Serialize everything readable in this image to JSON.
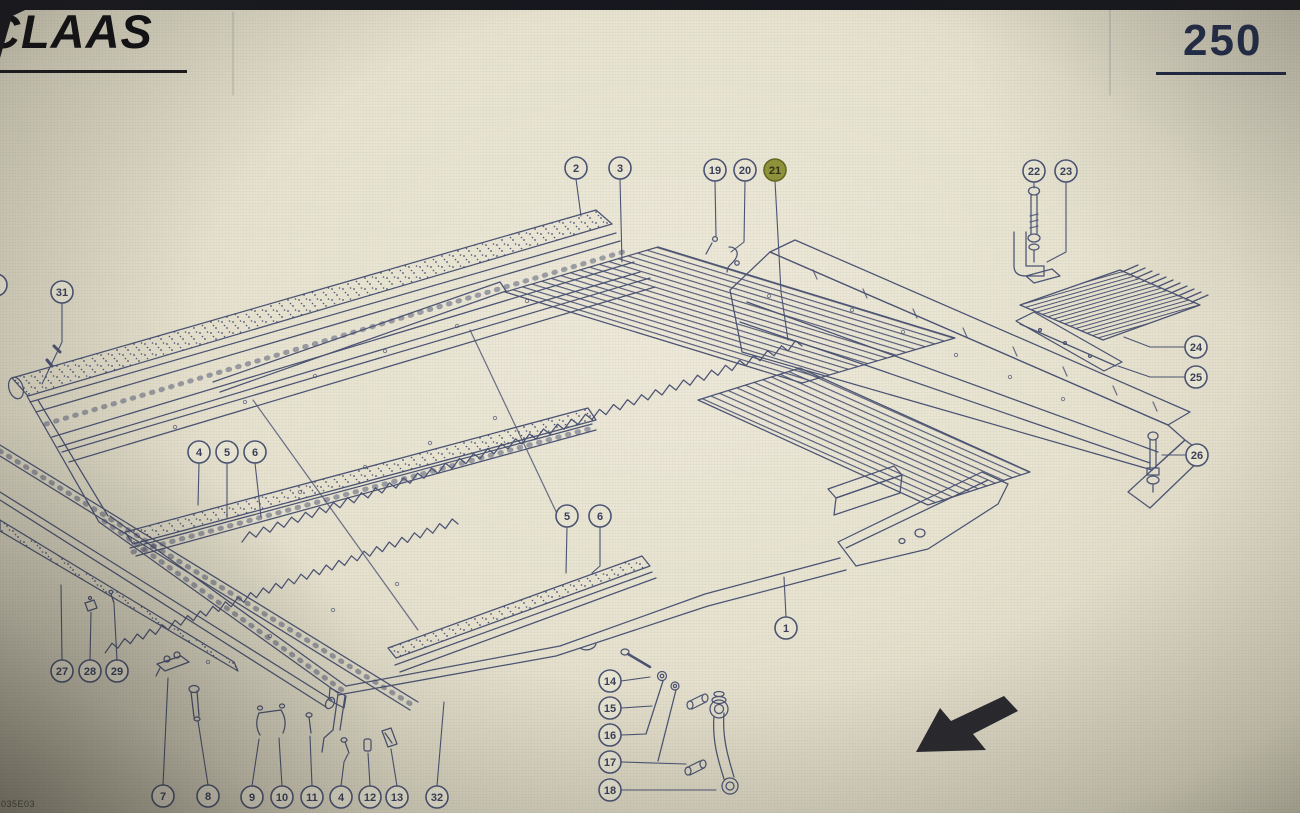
{
  "header": {
    "brand": "CLAAS",
    "page_number": "250"
  },
  "footer": {
    "doc_code": "035E03"
  },
  "colors": {
    "paper": "#e7e3d0",
    "paper_edge": "#cdc8b2",
    "line": "#414a6e",
    "line_dark": "#2e3552",
    "balloon": "#ebe7d5",
    "hl_fill": "#8a8e2f",
    "hl_stroke": "#5c6016",
    "hl_text": "#23270c",
    "ink": "#17181f",
    "pagenum": "#24304f",
    "logo": "#101014",
    "doccode": "#44443c"
  },
  "callouts": [
    {
      "label": "2",
      "x": 576,
      "y": 168,
      "leader": [
        [
          576,
          179
        ],
        [
          581,
          216
        ]
      ]
    },
    {
      "label": "3",
      "x": 620,
      "y": 168,
      "leader": [
        [
          620,
          179
        ],
        [
          622,
          262
        ]
      ]
    },
    {
      "label": "19",
      "x": 715,
      "y": 170,
      "leader": [
        [
          715,
          181
        ],
        [
          716,
          236
        ]
      ]
    },
    {
      "label": "20",
      "x": 745,
      "y": 170,
      "leader": [
        [
          745,
          181
        ],
        [
          744,
          242
        ],
        [
          731,
          252
        ]
      ]
    },
    {
      "label": "21",
      "x": 775,
      "y": 170,
      "highlighted": true,
      "leader": [
        [
          775,
          181
        ],
        [
          781,
          292
        ],
        [
          788,
          340
        ]
      ]
    },
    {
      "label": "22",
      "x": 1034,
      "y": 171,
      "leader": [
        [
          1034,
          182
        ],
        [
          1034,
          188
        ]
      ]
    },
    {
      "label": "23",
      "x": 1066,
      "y": 171,
      "leader": [
        [
          1066,
          182
        ],
        [
          1066,
          252
        ],
        [
          1047,
          262
        ]
      ]
    },
    {
      "label": "24",
      "x": 1196,
      "y": 347,
      "leader": [
        [
          1185,
          347
        ],
        [
          1150,
          347
        ],
        [
          1124,
          337
        ]
      ]
    },
    {
      "label": "25",
      "x": 1196,
      "y": 377,
      "leader": [
        [
          1185,
          377
        ],
        [
          1150,
          377
        ],
        [
          1118,
          366
        ]
      ]
    },
    {
      "label": "26",
      "x": 1197,
      "y": 455,
      "leader": [
        [
          1185,
          455
        ],
        [
          1162,
          455
        ]
      ]
    },
    {
      "label": "31",
      "x": 62,
      "y": 292,
      "leader": [
        [
          62,
          303
        ],
        [
          62,
          342
        ],
        [
          42,
          384
        ]
      ]
    },
    {
      "label": "4",
      "x": 199,
      "y": 452,
      "leader": [
        [
          199,
          463
        ],
        [
          198,
          505
        ]
      ]
    },
    {
      "label": "5",
      "x": 227,
      "y": 452,
      "leader": [
        [
          227,
          463
        ],
        [
          227,
          518
        ]
      ]
    },
    {
      "label": "6",
      "x": 255,
      "y": 452,
      "leader": [
        [
          255,
          463
        ],
        [
          261,
          517
        ]
      ]
    },
    {
      "label": "5",
      "x": 567,
      "y": 516,
      "leader": [
        [
          567,
          527
        ],
        [
          566,
          573
        ]
      ]
    },
    {
      "label": "6",
      "x": 600,
      "y": 516,
      "leader": [
        [
          600,
          527
        ],
        [
          600,
          566
        ],
        [
          592,
          573
        ]
      ]
    },
    {
      "label": "1",
      "x": 786,
      "y": 628,
      "leader": [
        [
          786,
          617
        ],
        [
          784,
          577
        ]
      ]
    },
    {
      "label": "27",
      "x": 62,
      "y": 671,
      "leader": [
        [
          62,
          660
        ],
        [
          61,
          585
        ]
      ]
    },
    {
      "label": "28",
      "x": 90,
      "y": 671,
      "leader": [
        [
          90,
          660
        ],
        [
          91,
          612
        ]
      ]
    },
    {
      "label": "29",
      "x": 117,
      "y": 671,
      "leader": [
        [
          117,
          660
        ],
        [
          114,
          604
        ]
      ]
    },
    {
      "label": "14",
      "x": 610,
      "y": 681,
      "leader": [
        [
          621,
          681
        ],
        [
          650,
          677
        ]
      ]
    },
    {
      "label": "15",
      "x": 610,
      "y": 708,
      "leader": [
        [
          621,
          708
        ],
        [
          652,
          706
        ]
      ]
    },
    {
      "label": "16",
      "x": 610,
      "y": 735,
      "leader": [
        [
          621,
          735
        ],
        [
          646,
          734
        ]
      ]
    },
    {
      "label": "17",
      "x": 610,
      "y": 762,
      "leader": [
        [
          621,
          762
        ],
        [
          686,
          764
        ]
      ]
    },
    {
      "label": "18",
      "x": 610,
      "y": 790,
      "leader": [
        [
          621,
          790
        ],
        [
          716,
          790
        ]
      ]
    },
    {
      "label": "7",
      "x": 163,
      "y": 796,
      "leader": [
        [
          163,
          785
        ],
        [
          168,
          678
        ]
      ]
    },
    {
      "label": "8",
      "x": 208,
      "y": 796,
      "leader": [
        [
          208,
          785
        ],
        [
          198,
          721
        ]
      ]
    },
    {
      "label": "9",
      "x": 252,
      "y": 797,
      "leader": [
        [
          252,
          786
        ],
        [
          259,
          739
        ]
      ]
    },
    {
      "label": "10",
      "x": 282,
      "y": 797,
      "leader": [
        [
          282,
          786
        ],
        [
          279,
          738
        ]
      ]
    },
    {
      "label": "11",
      "x": 312,
      "y": 797,
      "leader": [
        [
          312,
          786
        ],
        [
          310,
          736
        ]
      ]
    },
    {
      "label": "4",
      "x": 341,
      "y": 797,
      "leader": [
        [
          341,
          786
        ],
        [
          344,
          762
        ],
        [
          348,
          754
        ]
      ]
    },
    {
      "label": "12",
      "x": 370,
      "y": 797,
      "leader": [
        [
          370,
          786
        ],
        [
          368,
          753
        ]
      ]
    },
    {
      "label": "13",
      "x": 397,
      "y": 797,
      "leader": [
        [
          397,
          786
        ],
        [
          391,
          749
        ]
      ]
    },
    {
      "label": "32",
      "x": 437,
      "y": 797,
      "leader": [
        [
          437,
          786
        ],
        [
          444,
          702
        ]
      ]
    },
    {
      "label": "",
      "x": -4,
      "y": 285
    }
  ]
}
